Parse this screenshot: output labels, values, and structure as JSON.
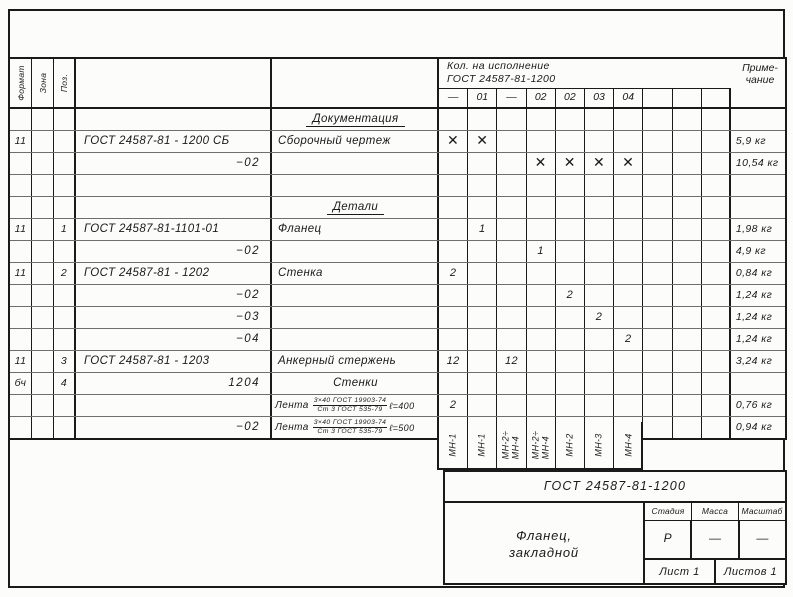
{
  "table": {
    "headers": {
      "format": "Формат",
      "zone": "Зона",
      "pos": "Поз.",
      "qty_group_line1": "Кол. на исполнение",
      "qty_group_line2": "ГОСТ 24587-81-1200",
      "qty_cols": [
        "—",
        "01",
        "—",
        "02",
        "02",
        "03",
        "04",
        "",
        "",
        ""
      ],
      "note_line1": "Приме-",
      "note_line2": "чание"
    },
    "rows": [
      {
        "type": "section",
        "n": "Документация"
      },
      {
        "type": "item",
        "f": "11",
        "z": "",
        "p": "",
        "d": "ГОСТ 24587-81 - 1200 СБ",
        "da": "left",
        "n": "Сборочный чертеж",
        "q": [
          "✕",
          "✕",
          "",
          "",
          "",
          "",
          "",
          "",
          "",
          ""
        ],
        "note": "5,9 кг"
      },
      {
        "type": "item",
        "f": "",
        "z": "",
        "p": "",
        "d": "−02",
        "da": "right",
        "n": "",
        "q": [
          "",
          "",
          "",
          "✕",
          "✕",
          "✕",
          "✕",
          "",
          "",
          ""
        ],
        "note": "10,54 кг"
      },
      {
        "type": "item",
        "f": "",
        "z": "",
        "p": "",
        "d": "",
        "n": "",
        "q": [],
        "note": ""
      },
      {
        "type": "section",
        "n": "Детали"
      },
      {
        "type": "item",
        "f": "11",
        "z": "",
        "p": "1",
        "d": "ГОСТ 24587-81-1101-01",
        "da": "left",
        "n": "Фланец",
        "q": [
          "",
          "1",
          "",
          "",
          "",
          "",
          "",
          "",
          "",
          ""
        ],
        "note": "1,98 кг"
      },
      {
        "type": "item",
        "f": "",
        "z": "",
        "p": "",
        "d": "−02",
        "da": "right",
        "n": "",
        "q": [
          "",
          "",
          "",
          "1",
          "",
          "",
          "",
          "",
          "",
          ""
        ],
        "note": "4,9 кг"
      },
      {
        "type": "item",
        "f": "11",
        "z": "",
        "p": "2",
        "d": "ГОСТ 24587-81 - 1202",
        "da": "left",
        "n": "Стенка",
        "q": [
          "2",
          "",
          "",
          "",
          "",
          "",
          "",
          "",
          "",
          ""
        ],
        "note": "0,84 кг"
      },
      {
        "type": "item",
        "f": "",
        "z": "",
        "p": "",
        "d": "−02",
        "da": "right",
        "n": "",
        "q": [
          "",
          "",
          "",
          "",
          "2",
          "",
          "",
          "",
          "",
          ""
        ],
        "note": "1,24 кг"
      },
      {
        "type": "item",
        "f": "",
        "z": "",
        "p": "",
        "d": "−03",
        "da": "right",
        "n": "",
        "q": [
          "",
          "",
          "",
          "",
          "",
          "2",
          "",
          "",
          "",
          ""
        ],
        "note": "1,24 кг"
      },
      {
        "type": "item",
        "f": "",
        "z": "",
        "p": "",
        "d": "−04",
        "da": "right",
        "n": "",
        "q": [
          "",
          "",
          "",
          "",
          "",
          "",
          "2",
          "",
          "",
          ""
        ],
        "note": "1,24 кг"
      },
      {
        "type": "item",
        "f": "11",
        "z": "",
        "p": "3",
        "d": "ГОСТ 24587-81 - 1203",
        "da": "left",
        "n": "Анкерный стержень",
        "q": [
          "12",
          "",
          "12",
          "",
          "",
          "",
          "",
          "",
          "",
          ""
        ],
        "note": "3,24 кг"
      },
      {
        "type": "item",
        "f": "бч",
        "z": "",
        "p": "4",
        "d": "1204",
        "da": "right",
        "n": "Стенки",
        "nAlign": "center",
        "q": [],
        "note": ""
      },
      {
        "type": "item",
        "f": "",
        "z": "",
        "p": "",
        "d": "",
        "da": "left",
        "lenta": {
          "prefix": "Лента",
          "num": "3×40 ГОСТ 19903-74",
          "den": "Ст 3 ГОСТ 535-79",
          "len": "ℓ=400"
        },
        "q": [
          "2",
          "",
          "",
          "",
          "",
          "",
          "",
          "",
          "",
          ""
        ],
        "note": "0,76 кг"
      },
      {
        "type": "item",
        "f": "",
        "z": "",
        "p": "",
        "d": "−02",
        "da": "right",
        "lenta": {
          "prefix": "Лента",
          "num": "3×40 ГОСТ 19903-74",
          "den": "Ст 3 ГОСТ 535-79",
          "len": "ℓ=500"
        },
        "q": [
          "",
          "",
          "",
          "2",
          "",
          "",
          "",
          "",
          "",
          ""
        ],
        "note": "0,94 кг"
      }
    ]
  },
  "mn_labels": [
    [
      "МН-1"
    ],
    [
      "МН-1"
    ],
    [
      "МН-2÷",
      "МН-4"
    ],
    [
      "МН-2÷",
      "МН-4"
    ],
    [
      "МН-2"
    ],
    [
      "МН-3"
    ],
    [
      "МН-4"
    ]
  ],
  "title_block": {
    "doc_number": "ГОСТ 24587-81-1200",
    "title_line1": "Фланец,",
    "title_line2": "закладной",
    "stage_label": "Стадия",
    "mass_label": "Масса",
    "scale_label": "Масштаб",
    "stage_value": "Р",
    "mass_value": "—",
    "scale_value": "—",
    "sheet": "Лист 1",
    "sheets": "Листов 1"
  }
}
